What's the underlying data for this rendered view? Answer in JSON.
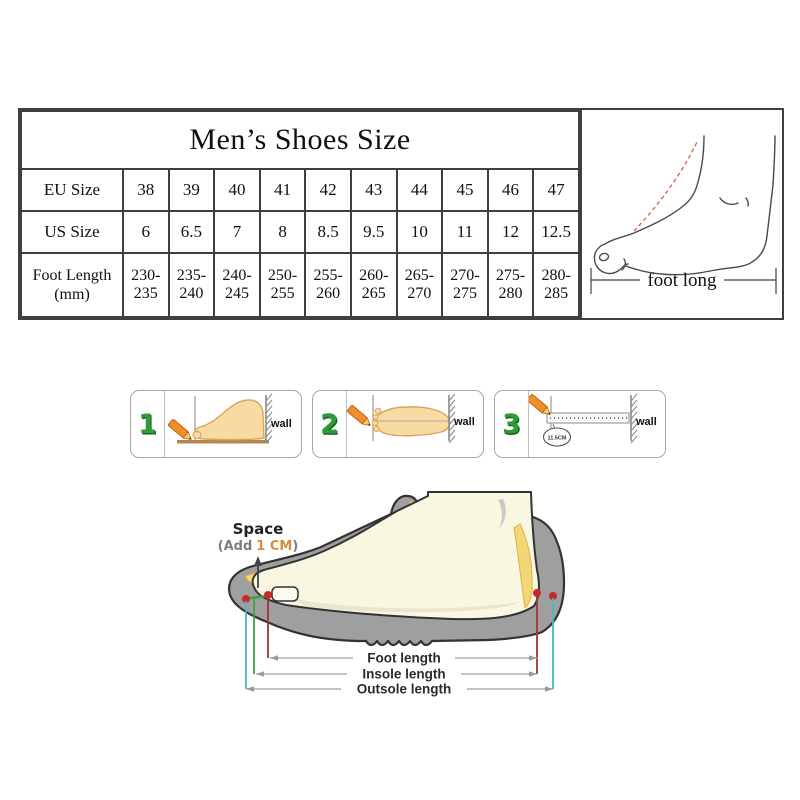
{
  "size_table": {
    "title": "Men’s Shoes Size",
    "row_labels": {
      "eu": "EU Size",
      "us": "US Size",
      "foot_length_line1": "Foot Length",
      "foot_length_line2": "(mm)"
    },
    "eu_sizes": [
      "38",
      "39",
      "40",
      "41",
      "42",
      "43",
      "44",
      "45",
      "46",
      "47"
    ],
    "us_sizes": [
      "6",
      "6.5",
      "7",
      "8",
      "8.5",
      "9.5",
      "10",
      "11",
      "12",
      "12.5"
    ],
    "foot_length_mm": [
      "230-235",
      "235-240",
      "240-245",
      "250-255",
      "255-260",
      "260-265",
      "265-270",
      "270-275",
      "275-280",
      "280-285"
    ]
  },
  "foot_measure": {
    "caption": "foot long"
  },
  "steps": [
    {
      "number": "1",
      "wall_label": "wall"
    },
    {
      "number": "2",
      "wall_label": "wall"
    },
    {
      "number": "3",
      "wall_label": "wall",
      "ruler_note": "11.5CM"
    }
  ],
  "shoe_diagram": {
    "space_title": "Space",
    "add_prefix": "(Add",
    "add_value": "1 CM",
    "add_suffix": ")",
    "measurements": {
      "foot": "Foot length",
      "insole": "Insole length",
      "outsole": "Outsole length"
    }
  },
  "colors": {
    "table_border": "#3f3f3f",
    "step_number_green": "#2d9b38",
    "pencil_orange": "#ef8e2a",
    "skin_tan": "#f8dba2",
    "insole_yellow": "#f4d677",
    "shoe_gray": "#9f9f9f",
    "foot_cream": "#f9f6e2",
    "marker_dot_red": "#c82a2a",
    "line_red": "#a03535",
    "line_green": "#3aa04a",
    "line_teal": "#49b9c2",
    "add_value_orange": "#d29038",
    "dashed_instep_red": "#d4604a",
    "board_brown": "#b5854f"
  }
}
